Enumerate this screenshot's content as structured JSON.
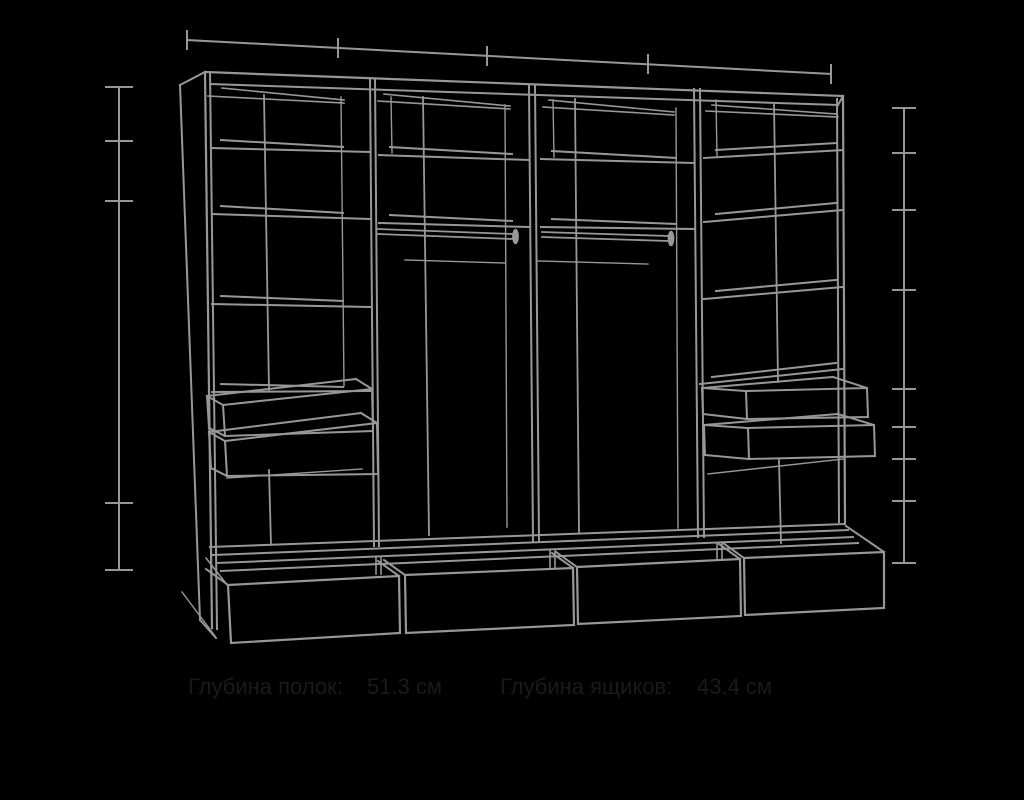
{
  "colors": {
    "background": "#000000",
    "line": "#979797",
    "label_text": "#1a1a1a"
  },
  "labels": {
    "shelf_depth": {
      "label": "Глубина полок:",
      "value": "51.3 см"
    },
    "drawer_depth": {
      "label": "Глубина ящиков:",
      "value": "43.4 см"
    }
  },
  "diagram": {
    "type": "wardrobe-technical-wireframe-perspective",
    "sections": 4,
    "hanging_rods": 2,
    "small_drawers_left_section": 2,
    "small_drawers_right_section": 2,
    "base_drawers": 4,
    "top_dimension_ticks": 5,
    "left_dimension_ticks": 5,
    "right_dimension_ticks": 9
  }
}
